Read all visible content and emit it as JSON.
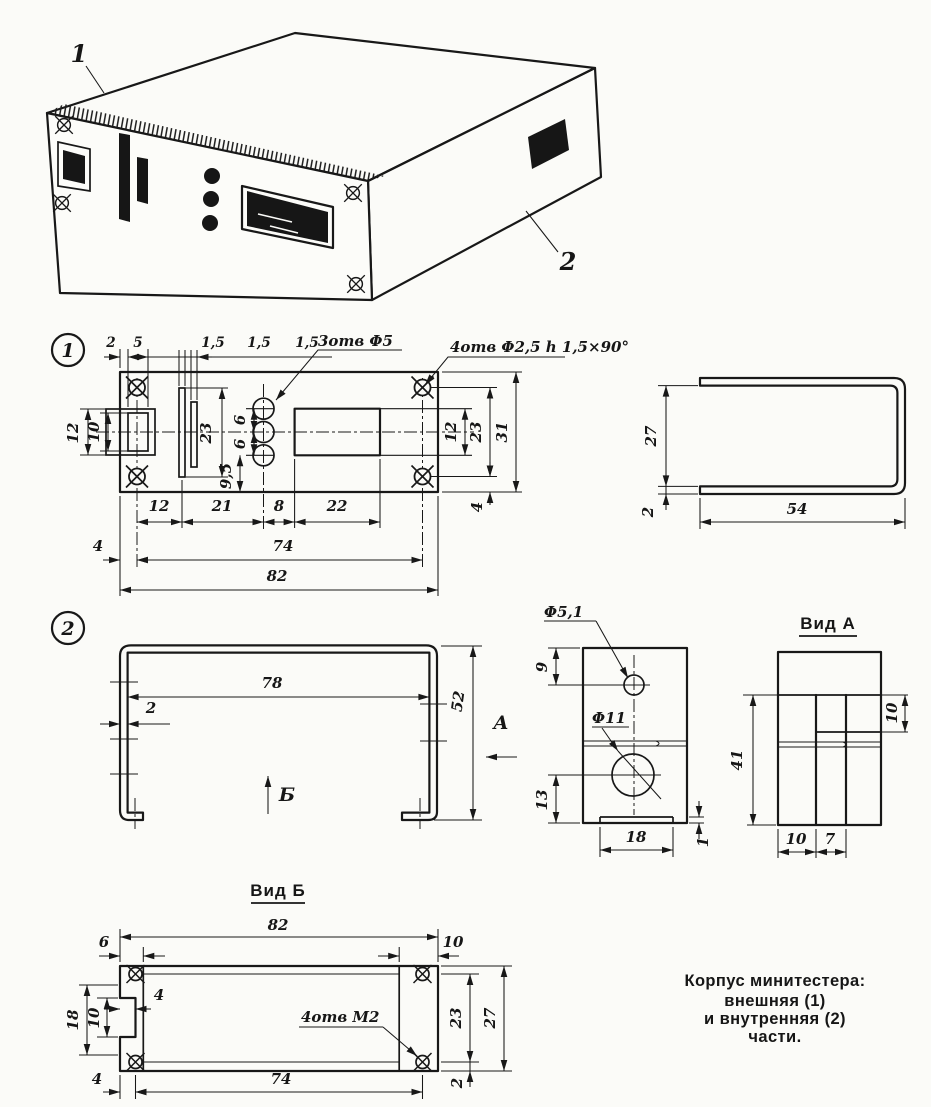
{
  "iso": {
    "callout1": "1",
    "callout2": "2"
  },
  "v1": {
    "badge": "1",
    "top": [
      "2",
      "5",
      "1,5",
      "1,5",
      "1,5"
    ],
    "otv3": "3отв Φ5",
    "otv4": "4отв Φ2,5 h 1,5×90°",
    "left12": "12",
    "left10": "10",
    "m23": "23",
    "m95": "9,5",
    "m6a": "6",
    "m6b": "6",
    "r12": "12",
    "r23": "23",
    "r31": "31",
    "r4": "4",
    "b12": "12",
    "b21": "21",
    "b8": "8",
    "b22": "22",
    "b4": "4",
    "b74": "74",
    "b82": "82"
  },
  "ch": {
    "d27": "27",
    "d2": "2",
    "d54": "54"
  },
  "v2": {
    "badge": "2",
    "d78": "78",
    "d2": "2",
    "d52": "52",
    "a": "А",
    "b": "Б"
  },
  "sp": {
    "phi51": "Φ5,1",
    "phi11": "Φ11",
    "d9": "9",
    "d13": "13",
    "d18": "18",
    "d1": "1"
  },
  "va": {
    "title": "Вид А",
    "d41": "41",
    "d10r": "10",
    "d10": "10",
    "d7": "7"
  },
  "vb": {
    "title": "Вид Б",
    "d82": "82",
    "d6": "6",
    "d10t": "10",
    "d18": "18",
    "d10l": "10",
    "d4n": "4",
    "otv": "4отв М2",
    "d23": "23",
    "d27": "27",
    "d2": "2",
    "d4b": "4",
    "d74": "74"
  },
  "cap": {
    "l1": "Корпус минитестера:",
    "l2": "внешняя (1)",
    "l3": "и внутренняя (2)",
    "l4": "части."
  }
}
